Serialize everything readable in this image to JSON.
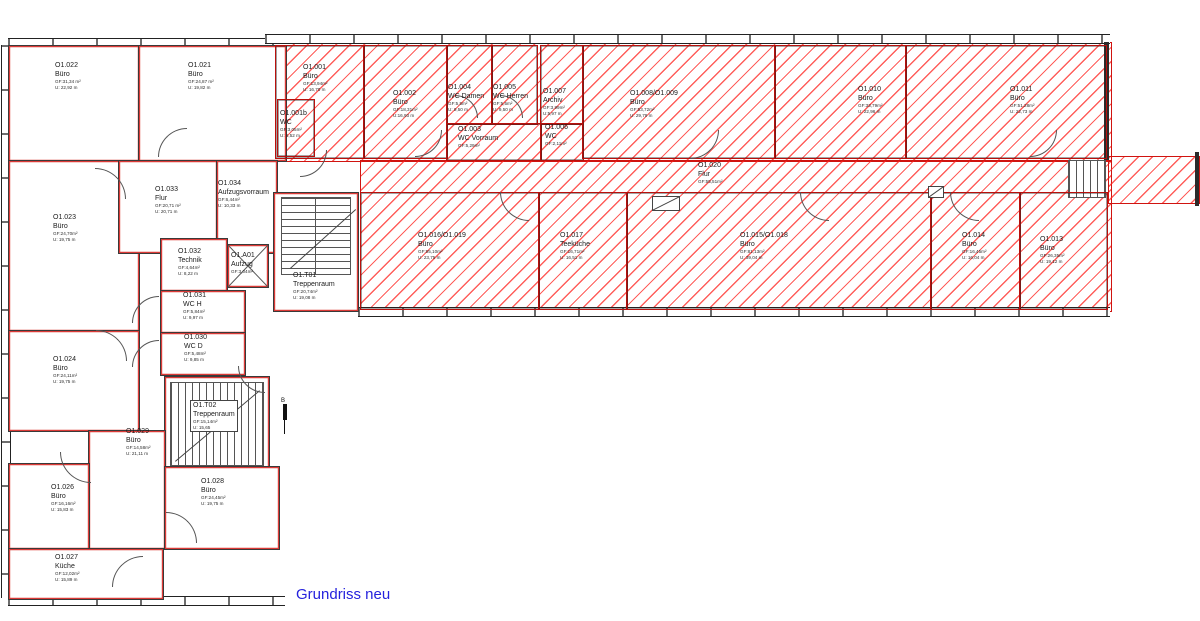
{
  "annotation": {
    "title": "Grundriss neu",
    "section_marker": "B"
  },
  "colors": {
    "hatch_red": "#ff201c",
    "wall_black": "#2b2b2b",
    "annotation_blue": "#2522dd"
  },
  "rooms": {
    "r022": {
      "id": "O1.022",
      "type": "Büro",
      "gf": "GF:31,34 m²",
      "u": "U: 22,92 m"
    },
    "r021": {
      "id": "O1.021",
      "type": "Büro",
      "gf": "GF:24,87 m²",
      "u": "U: 19,82 m"
    },
    "r023": {
      "id": "O1.023",
      "type": "Büro",
      "gf": "GF:24,70m²",
      "u": "U: 19,75 m"
    },
    "r024": {
      "id": "O1.024",
      "type": "Büro",
      "gf": "GF:24,11m²",
      "u": "U: 19,75 m"
    },
    "r026": {
      "id": "O1.026",
      "type": "Büro",
      "gf": "GF:16,16m²",
      "u": "U: 15,83 m"
    },
    "r027": {
      "id": "O1.027",
      "type": "Küche",
      "gf": "GF:12,02m²",
      "u": "U: 15,89 m"
    },
    "r028": {
      "id": "O1.028",
      "type": "Büro",
      "gf": "GF:24,45m²",
      "u": "U: 19,75 m"
    },
    "r029": {
      "id": "O1.029",
      "type": "Büro",
      "gf": "GF:14,58m²",
      "u": "U: 21,11 m"
    },
    "r030": {
      "id": "O1.030",
      "type": "WC D",
      "gf": "GF:5,48m²",
      "u": "U: 9,85 m"
    },
    "r031": {
      "id": "O1.031",
      "type": "WC H",
      "gf": "GF:5,84m²",
      "u": "U: 9,97 m"
    },
    "r032": {
      "id": "O1.032",
      "type": "Technik",
      "gf": "GF:4,64m²",
      "u": "U: 8,22 m"
    },
    "r033": {
      "id": "O1.033",
      "type": "Flur",
      "gf": "GF:20,71 m²",
      "u": "U: 20,71 m"
    },
    "r034": {
      "id": "O1.034",
      "type": "Aufzugsvorraum",
      "gf": "GF:6,44m²",
      "u": "U: 10,33 m"
    },
    "rA01": {
      "id": "O1.A01",
      "type": "Aufzug",
      "gf": "GF:3,04m²",
      "u": ""
    },
    "rT01": {
      "id": "O1.T01",
      "type": "Treppenraum",
      "gf": "GF:20,74m²",
      "u": "U: 19,08 m"
    },
    "rT02": {
      "id": "O1.T02",
      "type": "Treppenraum",
      "gf": "GF:15,14m²",
      "u": "U: 15,65"
    },
    "r001": {
      "id": "O1.001",
      "type": "Büro",
      "gf": "GF:13,94m²",
      "u": "U: 16,70 m"
    },
    "r001b": {
      "id": "O1.001b",
      "type": "WC",
      "gf": "GF:3,05m²",
      "u": "U: 6,52 m"
    },
    "r002": {
      "id": "O1.002",
      "type": "Büro",
      "gf": "GF:18,31m²",
      "u": "U:16,93 m"
    },
    "r003": {
      "id": "O1.003",
      "type": "WC Vorraum",
      "gf": "GF:5,29m²",
      "u": "U: 9,35 m"
    },
    "r004": {
      "id": "O1.004",
      "type": "WC Damen",
      "gf": "GF:5,5m²",
      "u": "U: 9,50 m"
    },
    "r005": {
      "id": "O1.005",
      "type": "WC Herren",
      "gf": "GF:5,5m²",
      "u": "U: 9,50 m"
    },
    "r006": {
      "id": "O1.006",
      "type": "WC",
      "gf": "GF:2,11m²",
      "u": "U: 5,96 m"
    },
    "r007": {
      "id": "O1.007",
      "type": "Archiv",
      "gf": "GF:3,99m²",
      "u": "U:5,97 m"
    },
    "r008": {
      "id": "O1.008/O1.009",
      "type": "Büro",
      "gf": "GF:53,72m²",
      "u": "U: 29,79 m"
    },
    "r010": {
      "id": "O1.010",
      "type": "Büro",
      "gf": "GF:33,79m²",
      "u": "U: 22,96 m"
    },
    "r011": {
      "id": "O1.011",
      "type": "Büro",
      "gf": "GF:51,28m²",
      "u": "U: 22,73 m"
    },
    "r013": {
      "id": "O1.013",
      "type": "Büro",
      "gf": "GF:26,35m²",
      "u": "U: 19,12 m"
    },
    "r014": {
      "id": "O1.014",
      "type": "Büro",
      "gf": "GF:16,45m²",
      "u": "U: 16,04 m"
    },
    "r015": {
      "id": "O1.015/O1.018",
      "type": "Büro",
      "gf": "GF:81,13m²",
      "u": "U: 39,04 m"
    },
    "r016": {
      "id": "O1.016/O1.019",
      "type": "Büro",
      "gf": "GF:55,10m²",
      "u": "U: 23,75 m"
    },
    "r017": {
      "id": "O1.017",
      "type": "Teeküche",
      "gf": "GF:16,71m²",
      "u": "U: 16,51 m"
    },
    "r020": {
      "id": "O1.020",
      "type": "Flur",
      "gf": "GF:55,51m²",
      "u": ""
    }
  }
}
